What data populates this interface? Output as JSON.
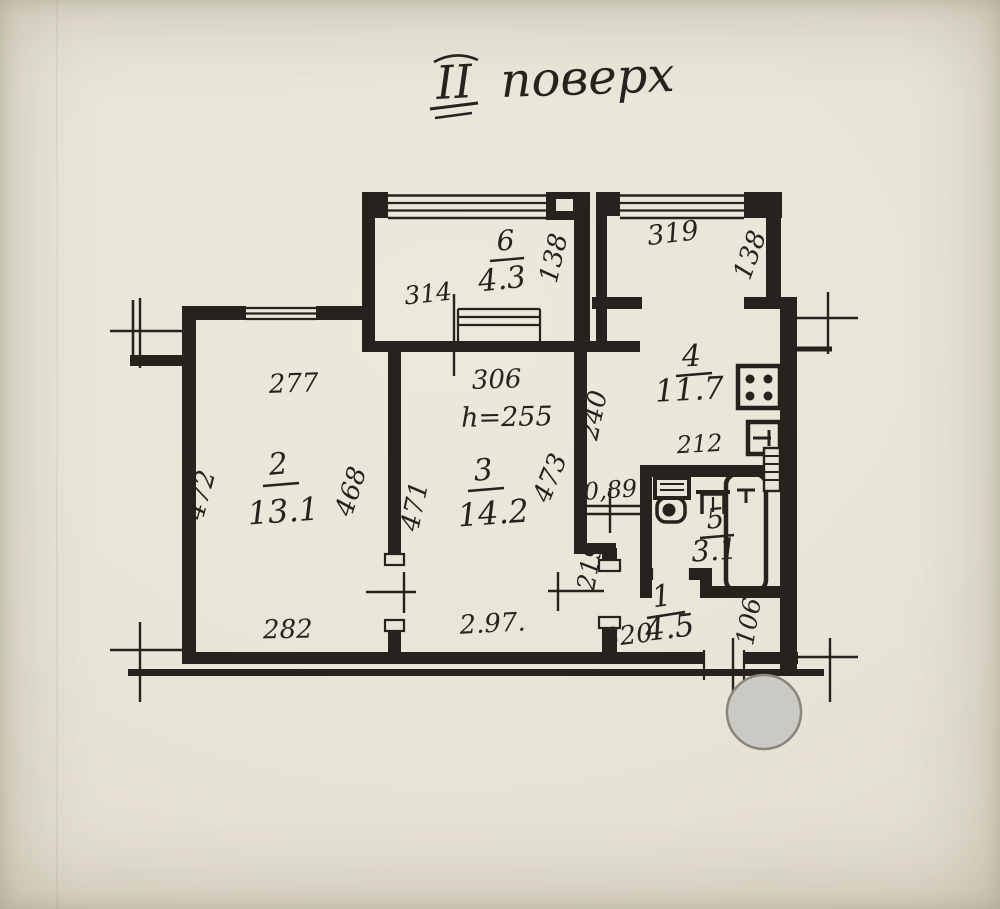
{
  "title": {
    "numeral": "ІІ",
    "word": "поверх"
  },
  "rooms": {
    "r1": {
      "number": "1",
      "area": "4.5"
    },
    "r2": {
      "number": "2",
      "area": "13.1"
    },
    "r3": {
      "number": "3",
      "area": "14.2"
    },
    "r4": {
      "number": "4",
      "area": "11.7"
    },
    "r5": {
      "number": "5",
      "area": "3.1"
    },
    "r6": {
      "number": "6",
      "area": "4.3"
    }
  },
  "dimensions": {
    "room2_top": "277",
    "room2_bottom": "282",
    "room2_left": "472",
    "room2_right": "468",
    "room3_top": "306",
    "room3_ceiling": "h=255",
    "room3_bottom": "2.97.",
    "room3_left": "471",
    "room3_right": "473",
    "balcony_top_width": "314",
    "balcony_top_depth": "138",
    "balcony_right_width": "319",
    "balcony_right_depth": "138",
    "kitchen_side": "240",
    "kitchen_inner": "212",
    "hall_opening": "0,89",
    "hall_side": "219",
    "hall_bottom": "320",
    "hall_nook": "106"
  },
  "colors": {
    "paper": "#e8e4d7",
    "ink": "#26221d",
    "stamp_fill": "#cbc9c3",
    "stamp_stroke": "#8a867c"
  }
}
